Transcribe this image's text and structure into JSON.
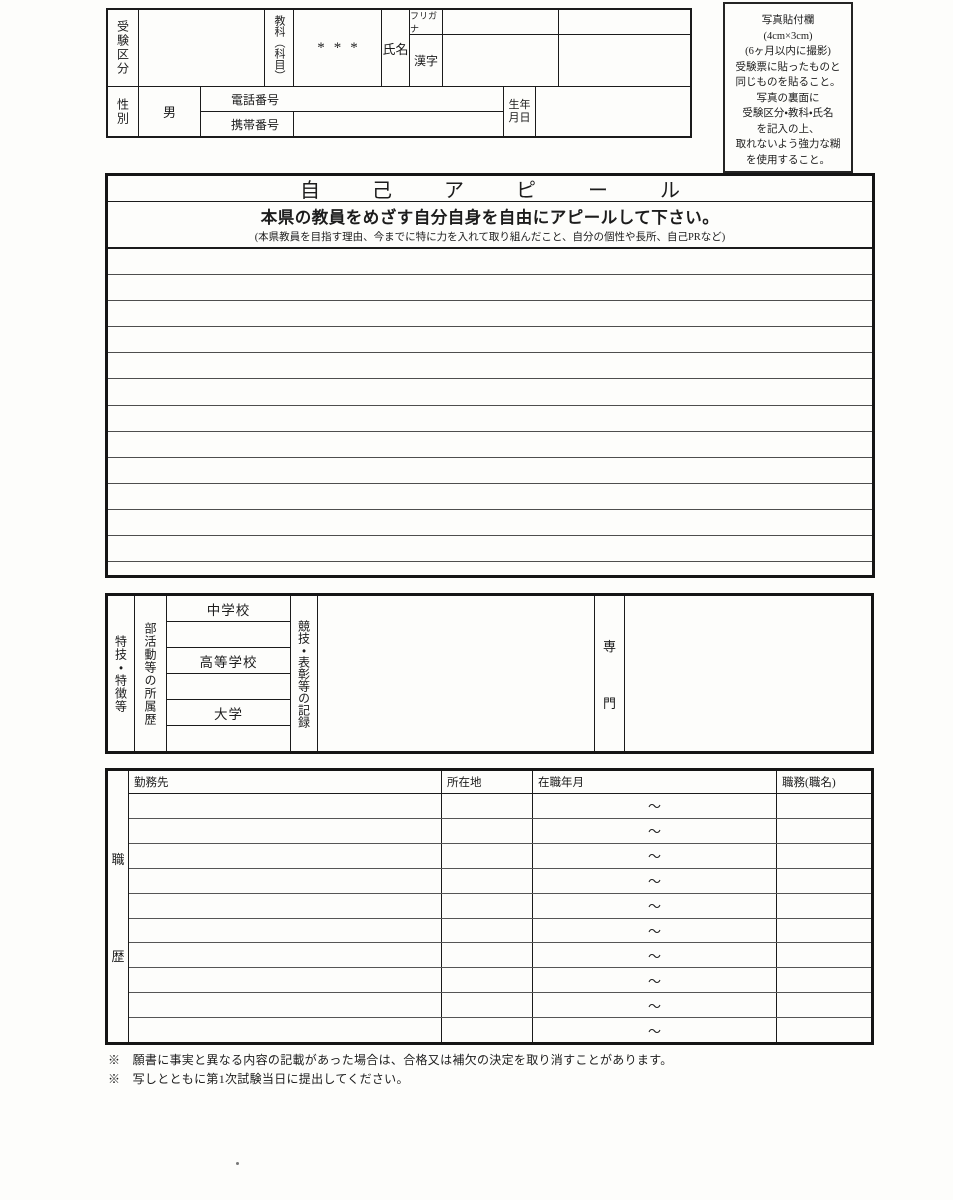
{
  "colors": {
    "ink": "#1c1c1c",
    "paper": "#fdfdfb"
  },
  "header": {
    "exam_category_label": "受験区分",
    "subject_label": "教科（科目）",
    "subject_value": "***",
    "name_label": "氏名",
    "furigana_label": "フリガナ",
    "kanji_label": "漢字",
    "gender_label": "性別",
    "gender_value": "男",
    "phone_label": "電話番号",
    "mobile_label": "携帯番号",
    "birthdate_label": [
      "生年",
      "月日"
    ]
  },
  "photo_box": {
    "lines": [
      "写真貼付欄",
      "(4cm×3cm)",
      "(6ヶ月以内に撮影)",
      "受験票に貼ったものと",
      "同じものを貼ること。",
      "写真の裏面に",
      "受験区分・教科・氏名",
      "を記入の上、",
      "取れないよう強力な糊",
      "を使用すること。"
    ]
  },
  "appeal": {
    "title": "自　己　ア　ピ　ー　ル",
    "subtitle": "本県の教員をめざす自分自身を自由にアピールして下さい。",
    "note": "(本県教員を目指す理由、今までに特に力を入れて取り組んだこと、自分の個性や長所、自己PRなど)",
    "line_count": 12
  },
  "skills": {
    "section_label": "特技・特徴等",
    "club_label": "部活動等の所属歴",
    "schools": [
      "中学校",
      "",
      "高等学校",
      "",
      "大学",
      ""
    ],
    "record_label": "競技・表彰等の記録",
    "specialty_label": "専門"
  },
  "work_history": {
    "section_label": "職歴",
    "columns": [
      "勤務先",
      "所在地",
      "在職年月",
      "職務(職名)"
    ],
    "row_count": 10,
    "tilde": "～"
  },
  "footnotes": [
    "※　願書に事実と異なる内容の記載があった場合は、合格又は補欠の決定を取り消すことがあります。",
    "※　写しとともに第1次試験当日に提出してください。"
  ]
}
